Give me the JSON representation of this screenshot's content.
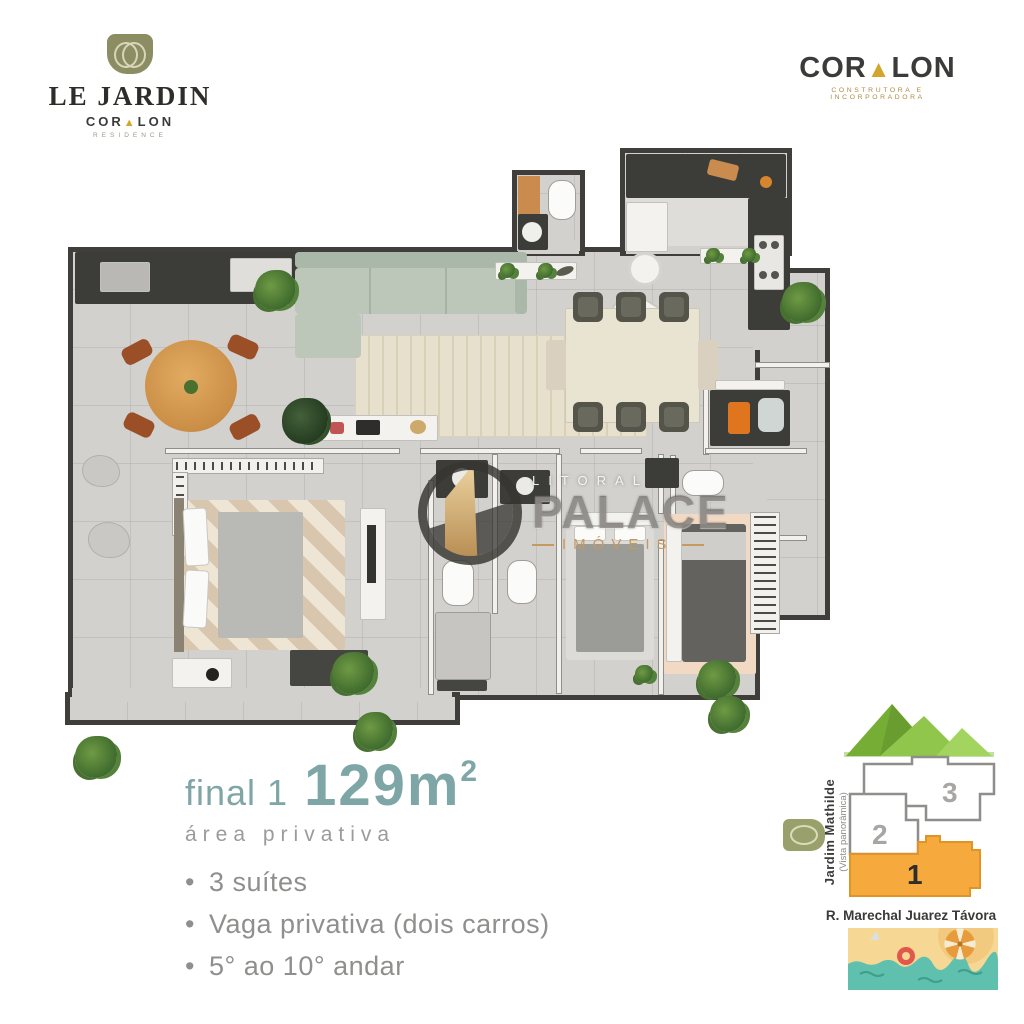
{
  "header": {
    "left_logo": {
      "title": "LE JARDIN",
      "brand_pre": "COR",
      "brand_a": "▲",
      "brand_post": "LON",
      "tagline": "RESIDENCE"
    },
    "right_logo": {
      "brand_pre": "COR",
      "brand_a": "▲",
      "brand_post": "LON",
      "tagline": "CONSTRUTORA E INCORPORADORA"
    }
  },
  "watermark": {
    "top": "LITORAL",
    "middle": "PALACE",
    "bottom": "IMÓVEIS"
  },
  "info": {
    "unit": "final 1",
    "area": "129m",
    "area_exp": "2",
    "area_label": "área privativa",
    "features": [
      "3 suítes",
      "Vaga privativa (dois carros)",
      "5° ao 10° andar"
    ]
  },
  "location": {
    "district": "Jardim Mathilde",
    "district_note": "(Vista panorâmica)",
    "street": "R. Marechal Juarez Távora",
    "units": [
      {
        "n": "3"
      },
      {
        "n": "2"
      },
      {
        "n": "1"
      }
    ],
    "highlight_color": "#F6A93C"
  },
  "colors": {
    "accent_teal": "#7FA6A6",
    "accent_gold": "#D2A62C",
    "wall": "#3F3E3B",
    "floor": "#D2D1CE",
    "sofa": "#BCC7BA",
    "wood": "#D89A52"
  }
}
